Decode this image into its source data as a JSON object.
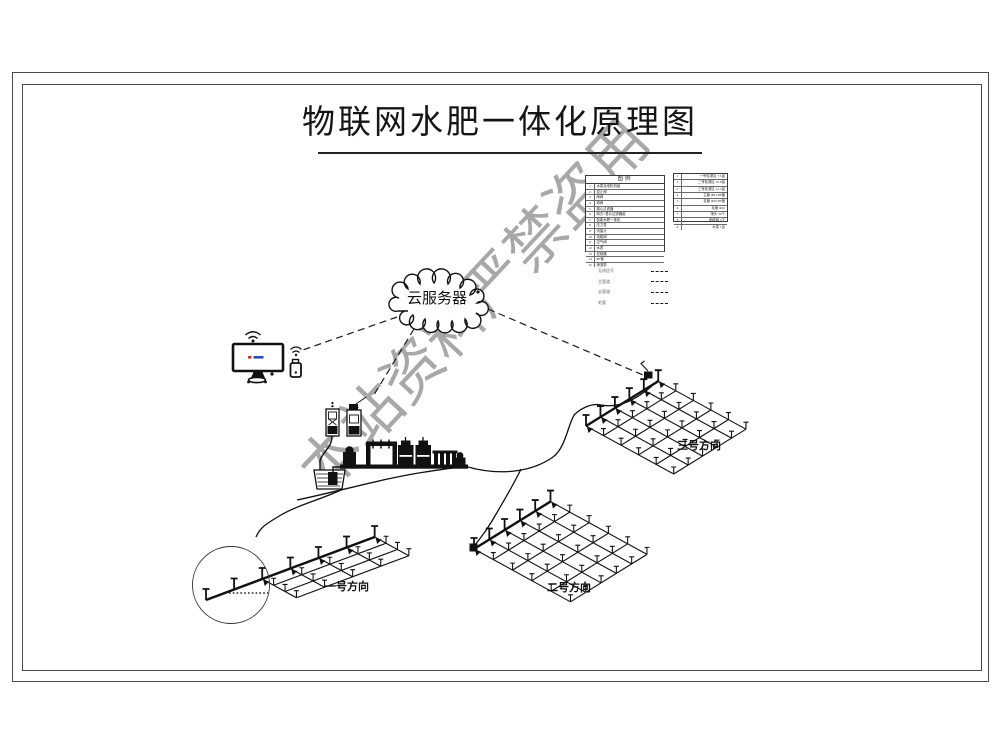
{
  "title": "物联网水肥一体化原理图",
  "watermark": "本站资料严禁盗用",
  "cloud": {
    "label": "云服务器"
  },
  "legend": {
    "title": "图例",
    "rows": [
      {
        "n": "1",
        "label": "水泵及电机机组"
      },
      {
        "n": "2",
        "label": "逆止阀"
      },
      {
        "n": "3",
        "label": "闸阀"
      },
      {
        "n": "4",
        "label": "球阀"
      },
      {
        "n": "5",
        "label": "离心过滤器"
      },
      {
        "n": "6",
        "label": "网式+叠片过滤器组"
      },
      {
        "n": "7",
        "label": "智能水肥一体机"
      },
      {
        "n": "8",
        "label": "压力表"
      },
      {
        "n": "9",
        "label": "流量计"
      },
      {
        "n": "10",
        "label": "电磁阀"
      },
      {
        "n": "11",
        "label": "空气阀"
      },
      {
        "n": "12",
        "label": "水表"
      },
      {
        "n": "13",
        "label": "控制器"
      },
      {
        "n": "14",
        "label": "PE管"
      },
      {
        "n": "15",
        "label": "滴灌带"
      }
    ],
    "line_types": [
      {
        "label": "无线信号"
      },
      {
        "label": "主管道"
      },
      {
        "label": "支管道"
      },
      {
        "label": "毛管"
      }
    ]
  },
  "spec_table": {
    "rows": [
      {
        "n": "1",
        "value": "一号轮灌区 7.5亩"
      },
      {
        "n": "2",
        "value": "二号轮灌区 10.8亩"
      },
      {
        "n": "3",
        "value": "三号轮灌区 12.5亩"
      },
      {
        "n": "4",
        "value": "主管 Φ63 PE管"
      },
      {
        "n": "5",
        "value": "支管 Φ50 PE管"
      },
      {
        "n": "6",
        "value": "毛管 Φ16"
      },
      {
        "n": "7",
        "value": "喷头 30个"
      },
      {
        "n": "8",
        "value": "电磁阀 3个"
      },
      {
        "n": "9",
        "value": "水泵 1台"
      }
    ]
  },
  "fields": [
    {
      "label": "一号方向"
    },
    {
      "label": "二号方向"
    },
    {
      "label": "三号方向"
    }
  ],
  "colors": {
    "line": "#111111",
    "watermark": "#9a9a9a",
    "screen_dash_red": "#c03a2b",
    "screen_dash_blue": "#2a4bbf"
  }
}
